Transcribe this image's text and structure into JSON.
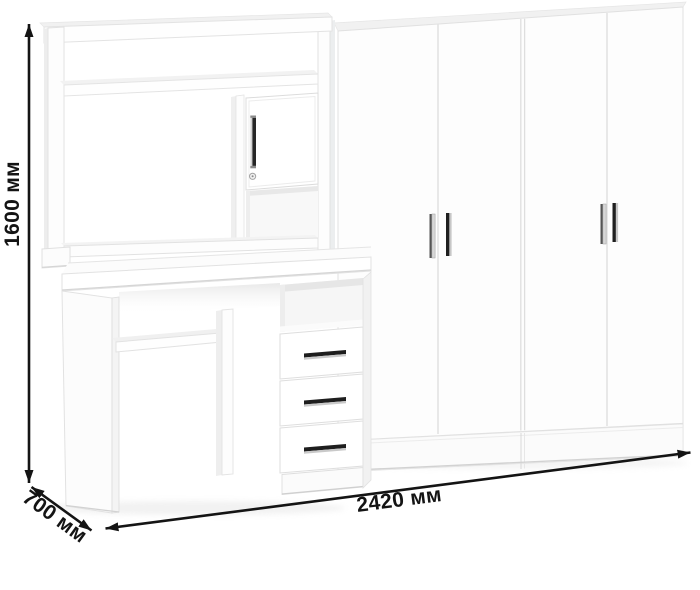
{
  "figure": {
    "background_color": "#ffffff",
    "furniture_color": "#fdfdfd",
    "edge_color": "#e2e2e2",
    "annotation_color": "#141414",
    "handle_dark_color": "#222222",
    "handle_light_color": "#cccccc"
  },
  "dimensions": {
    "height_label": "1600 мм",
    "depth_label": "700 мм",
    "width_label": "2420 мм"
  },
  "furniture": {
    "wardrobe_door_count": 4,
    "desk_drawer_count": 3,
    "hutch_cabinet_door_count": 1,
    "wardrobe_handle_count": 4,
    "drawer_handle_count": 3
  }
}
